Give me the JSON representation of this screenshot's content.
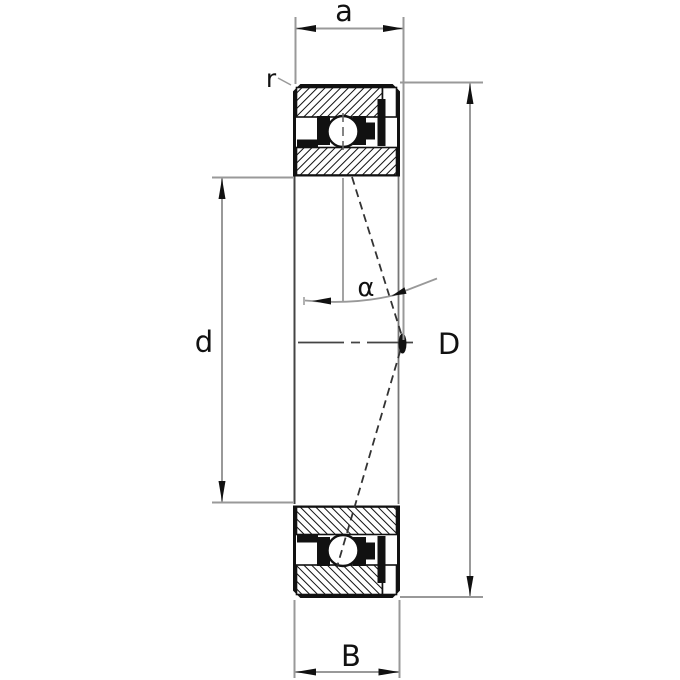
{
  "figure": {
    "labels": {
      "a": "a",
      "r": "r",
      "d": "d",
      "D": "D",
      "B": "B",
      "alpha": "α"
    },
    "colors": {
      "ink": "#111111",
      "dimension_line": "#999999",
      "centerline": "#444444",
      "background": "#ffffff"
    }
  }
}
